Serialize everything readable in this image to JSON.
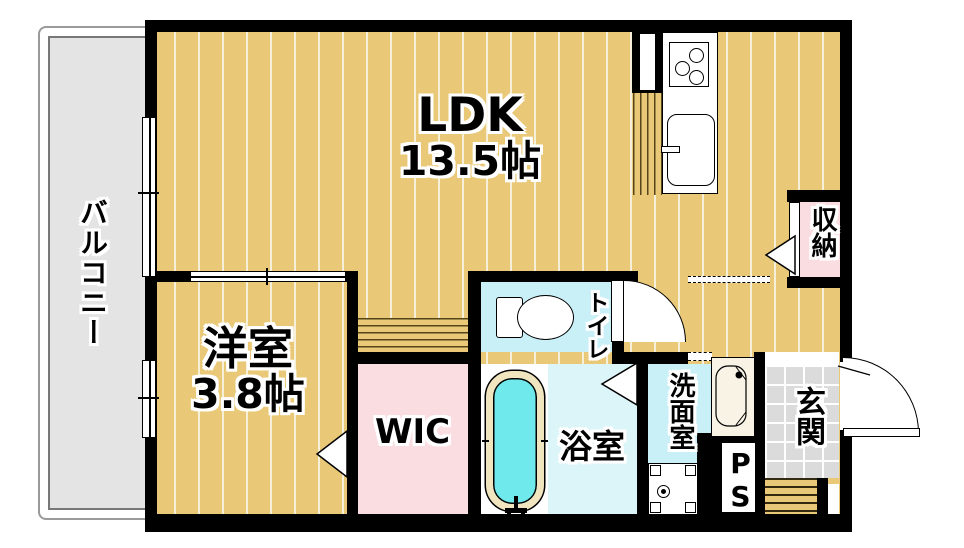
{
  "rooms": {
    "balcony": {
      "label": "バルコニー"
    },
    "ldk": {
      "label": "LDK",
      "size": "13.5帖"
    },
    "bedroom": {
      "label": "洋室",
      "size": "3.8帖"
    },
    "wic": {
      "label": "WIC"
    },
    "closet": {
      "label": "収納"
    },
    "toilet": {
      "label": "トイレ"
    },
    "bath": {
      "label": "浴室"
    },
    "washroom": {
      "label": "洗面室"
    },
    "entrance": {
      "label": "玄関"
    },
    "pipe_space": {
      "label": "PS"
    }
  },
  "colors": {
    "wall": "#000000",
    "floor": "#e9c878",
    "floor_stripe": "#f7f0d8",
    "balcony": "#e4e4e4",
    "wet_room": "#c9eff7",
    "bath_floor": "#dcf5f8",
    "closet_pink": "#fadde0",
    "entrance_tile": "#dbdbdb",
    "tub_water": "#6fe9eb",
    "tub_rim": "#f0e5bf"
  }
}
